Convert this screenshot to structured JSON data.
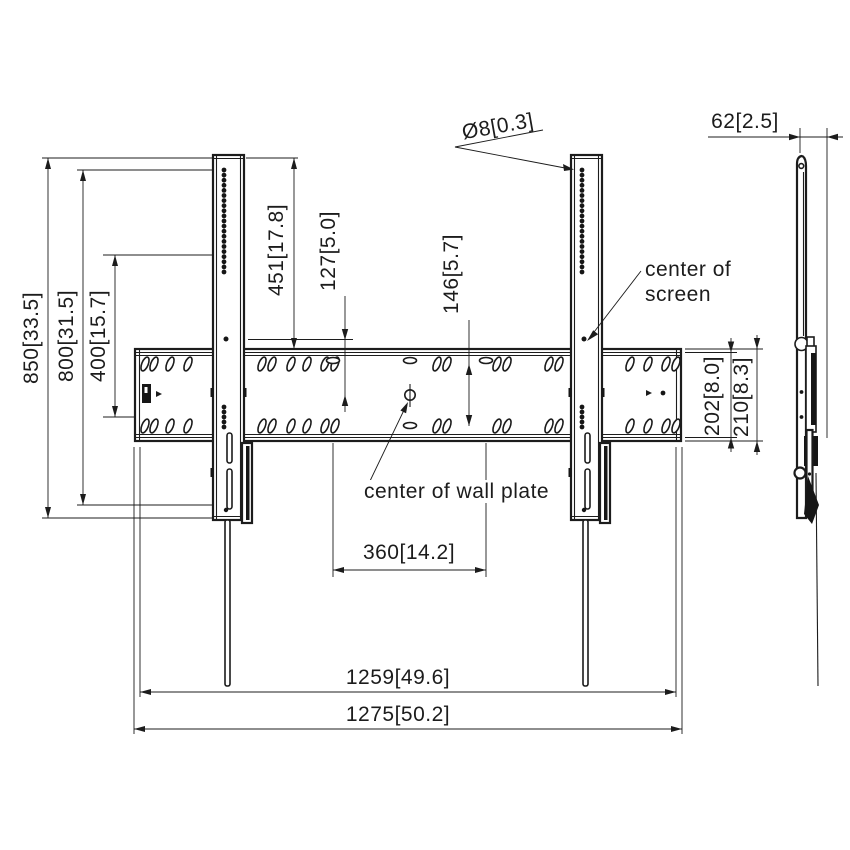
{
  "drawing": {
    "type": "technical-dimension-drawing",
    "subject": "TV wall mount - front view and side view",
    "colors": {
      "line": "#1c1c1c",
      "background": "#ffffff"
    },
    "dimensions": {
      "height_total": "850[33.5]",
      "rail_height": "800[31.5]",
      "vesa_vertical": "400[15.7]",
      "rail_top_to_plate": "451[17.8]",
      "screen_center_to_plate_center": "127[5.0]",
      "plate_hole_rows": "146[5.7]",
      "plate_inner_height": "202[8.0]",
      "plate_outer_height": "210[8.3]",
      "depth": "62[2.5]",
      "anchor_spacing": "360[14.2]",
      "width_inner": "1259[49.6]",
      "width_total": "1275[50.2]"
    },
    "labels": {
      "hole_callout": "Ø8[0.3]",
      "center_of_screen_line1": "center of",
      "center_of_screen_line2": "screen",
      "center_of_wall_plate": "center of wall plate"
    }
  }
}
